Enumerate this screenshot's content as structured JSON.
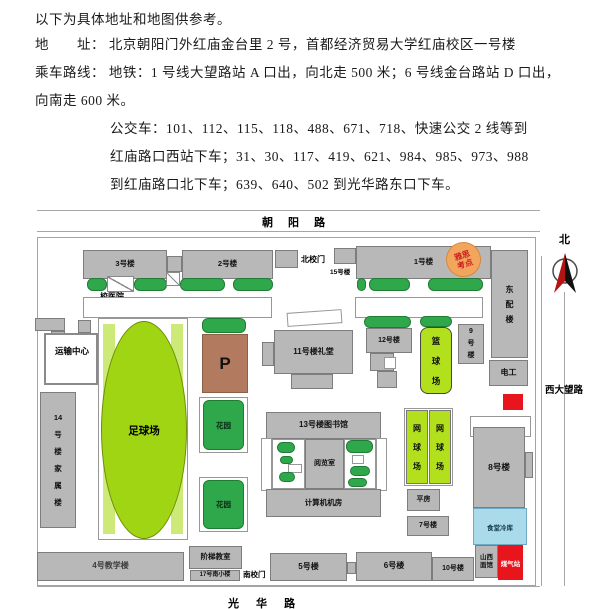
{
  "doc": {
    "line1": "以下为具体地址和地图供参考。",
    "line2": "地　　址：  北京朝阳门外红庙金台里 2 号，首都经济贸易大学红庙校区一号楼",
    "line3": "乘车路线：  地铁：1 号线大望路站 A 口出，向北走 500 米；6 号线金台路站 D 口出，",
    "line4": "向南走 600 米。",
    "line5": "公交车：101、112、115、118、488、671、718、快速公交 2 线等到",
    "line6": "红庙路口西站下车；31、30、117、419、621、984、985、973、988",
    "line7": "到红庙路口北下车；639、640、502 到光华路东口下车。"
  },
  "map": {
    "roads": {
      "north": "朝 阳 路",
      "south": "光 华 路",
      "west_vertical": "西大望路",
      "compass_north": "北"
    },
    "labels": {
      "bldg3": "3号楼",
      "bldg2": "2号楼",
      "north_gate": "北校门",
      "bldg15": "15号楼",
      "bldg1": "1号楼",
      "ielts1": "雅思",
      "ielts2": "考点",
      "east_annex": "东配楼",
      "clinic": "校医院",
      "transport_center": "运输中心",
      "bldg14": "14号楼家属楼",
      "football": "足球场",
      "parking": "P",
      "garden": "花园",
      "hall11": "11号楼礼堂",
      "bldg12": "12号楼",
      "basketball": "篮球场",
      "bldg9": "9号楼",
      "electric": "电工",
      "library13": "13号楼图书馆",
      "reading_room": "阅览室",
      "computer_room": "计算机机房",
      "tennis": "网球场",
      "bungalow": "平房",
      "bldg7": "7号楼",
      "bldg8": "8号楼",
      "canteen_cold": "食堂冷库",
      "shanxi1": "山西",
      "shanxi2": "面馆",
      "gas_station": "煤气站",
      "teaching4": "4号教学楼",
      "lecture_hall": "阶梯教室",
      "bldg17": "17号南小楼",
      "south_gate": "南校门",
      "bldg5": "5号楼",
      "bldg6": "6号楼",
      "bldg10": "10号楼"
    },
    "colors": {
      "building_gray": "#b8b8b8",
      "bush_green": "#2fa84b",
      "court_lime": "#b2e01d",
      "field_green": "#9fd513",
      "parking_brown": "#b27a5e",
      "cold_blue": "#a9dbeb",
      "alert_red": "#e8151c",
      "ielts_orange": "#f2a55c",
      "ielts_text_red": "#c92020"
    }
  }
}
